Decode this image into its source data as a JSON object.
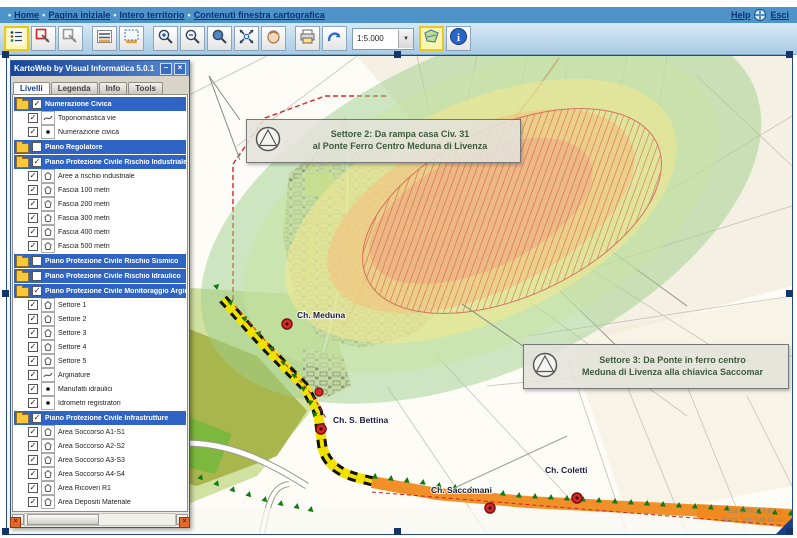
{
  "menubar": {
    "items": [
      {
        "label": "Home"
      },
      {
        "label": "Pagina iniziale"
      },
      {
        "label": "Intero territorio"
      },
      {
        "label": "Contenuti finestra cartografica"
      }
    ],
    "help_label": "Help",
    "exit_label": "Esci"
  },
  "toolbar": {
    "scale_value": "1:5.000",
    "buttons": [
      "layers",
      "identify",
      "clear-selection",
      "measure",
      "select-area",
      "zoom-in",
      "zoom-out",
      "zoom-window",
      "full-extent",
      "pan",
      "print",
      "redo",
      "overview-map",
      "info"
    ]
  },
  "panel": {
    "title": "KartoWeb by Visual Informatica 5.0.1",
    "tabs": [
      "Livelli",
      "Legenda",
      "Info",
      "Tools"
    ],
    "active_tab": "Livelli",
    "tree": [
      {
        "label": "Numerazione Civica",
        "checked": true,
        "children": [
          {
            "label": "Toponomastica vie",
            "icon": "line"
          },
          {
            "label": "Numerazione civica",
            "icon": "point"
          }
        ]
      },
      {
        "label": "Piano Regolatore",
        "checked": false,
        "children": []
      },
      {
        "label": "Piano Protezione Civile Rischio Industriale",
        "checked": true,
        "children": [
          {
            "label": "Aree a rischio industriale",
            "icon": "polygon"
          },
          {
            "label": "Fascia 100 metri",
            "icon": "polygon"
          },
          {
            "label": "Fascia 200 metri",
            "icon": "polygon"
          },
          {
            "label": "Fascia 300 metri",
            "icon": "polygon"
          },
          {
            "label": "Fascia 400 metri",
            "icon": "polygon"
          },
          {
            "label": "Fascia 500 metri",
            "icon": "polygon"
          }
        ]
      },
      {
        "label": "Piano Protezione Civile Rischio Sismico",
        "checked": false,
        "children": []
      },
      {
        "label": "Piano Protezione Civile Rischio Idraulico",
        "checked": false,
        "children": []
      },
      {
        "label": "Piano Protezione Civile Monitoraggio Argini",
        "checked": true,
        "children": [
          {
            "label": "Settore 1",
            "icon": "polygon"
          },
          {
            "label": "Settore 2",
            "icon": "polygon"
          },
          {
            "label": "Settore 3",
            "icon": "polygon"
          },
          {
            "label": "Settore 4",
            "icon": "polygon"
          },
          {
            "label": "Settore 5",
            "icon": "polygon"
          },
          {
            "label": "Arginature",
            "icon": "line"
          },
          {
            "label": "Manufatti idraulici",
            "icon": "point"
          },
          {
            "label": "Idrometri registratori",
            "icon": "point"
          }
        ]
      },
      {
        "label": "Piano Protezione Civile Infrastrutture",
        "checked": true,
        "children": [
          {
            "label": "Area Soccorso A1-S1",
            "icon": "polygon"
          },
          {
            "label": "Area Soccorso A2-S2",
            "icon": "polygon"
          },
          {
            "label": "Area Soccorso A3-S3",
            "icon": "polygon"
          },
          {
            "label": "Area Soccorso A4-S4",
            "icon": "polygon"
          },
          {
            "label": "Area Ricoveri R1",
            "icon": "polygon"
          },
          {
            "label": "Area Depositi Materiale",
            "icon": "polygon"
          }
        ]
      }
    ]
  },
  "map": {
    "callouts": [
      {
        "line1": "Settore 2: Da rampa casa Civ. 31",
        "line2": "al Ponte Ferro Centro Meduna di Livenza"
      },
      {
        "line1": "Settore 3: Da Ponte in ferro centro",
        "line2": "Meduna di Livenza alla chiavica Saccomar"
      }
    ],
    "labels": [
      "Ch. Meduna",
      "Ch. S. Bettina",
      "Ch. Saccomani",
      "Ch. Coletti"
    ],
    "coordinates": {
      "line1": "Est: 1791177.87 m",
      "line2": "Nord: 5087148.81 m"
    }
  },
  "colors": {
    "menubar_blue": "#4e94c8",
    "header_blue": "#2f64c4",
    "band_yellow": "#f2e200",
    "band_orange": "#f08a1e",
    "risk_red": "#cc3333",
    "zone_green": "#9ecf8b"
  }
}
